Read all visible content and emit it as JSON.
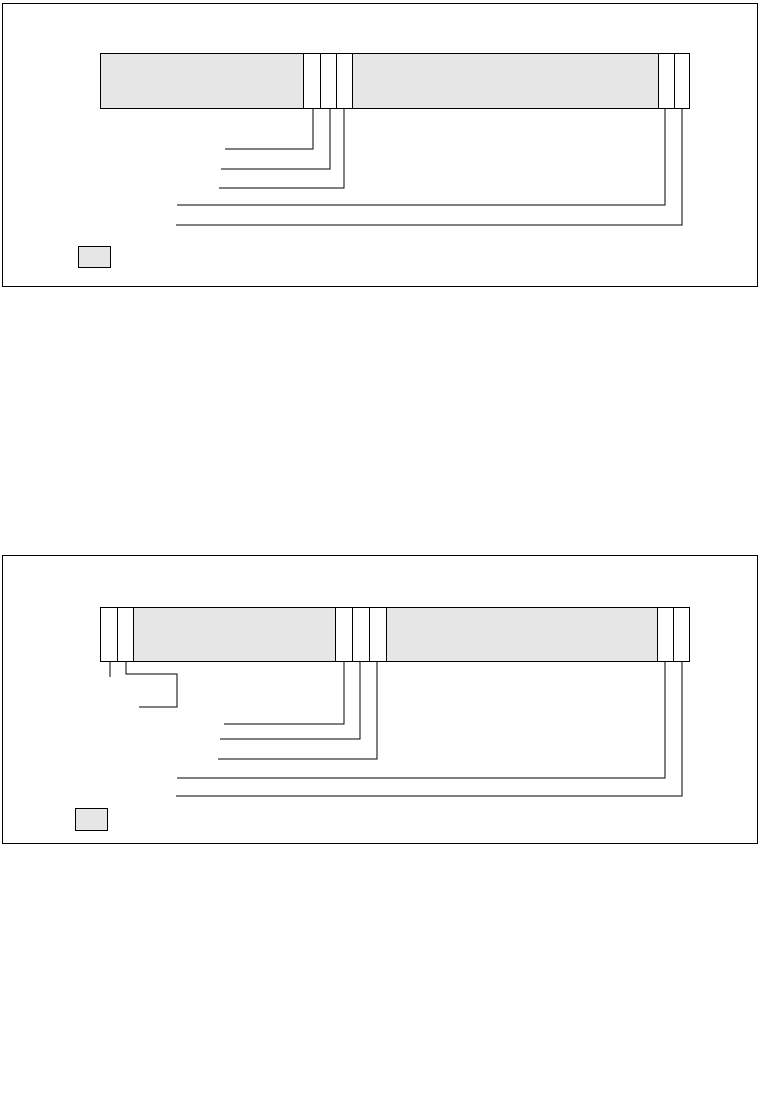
{
  "page": {
    "width": 760,
    "height": 1107,
    "background": "#ffffff"
  },
  "colors": {
    "line": "#000000",
    "field_fill": "#e6e6e6",
    "empty_fill": "#ffffff",
    "swatch_fill": "#e6e6e6"
  },
  "diagrams": [
    {
      "id": "field-structure-figure-1",
      "box": {
        "x": 2,
        "y": 3,
        "w": 756,
        "h": 284
      },
      "bar": {
        "x": 97,
        "y": 49,
        "w": 590,
        "h": 56
      },
      "cells": [
        {
          "w": 203,
          "fill": "field"
        },
        {
          "w": 17,
          "fill": "empty"
        },
        {
          "w": 16,
          "fill": "empty"
        },
        {
          "w": 16,
          "fill": "empty"
        },
        {
          "w": 307,
          "fill": "field"
        },
        {
          "w": 16,
          "fill": "empty"
        },
        {
          "w": 15,
          "fill": "empty"
        }
      ],
      "leaders": [
        [
          [
            310,
            105
          ],
          [
            310,
            145
          ],
          [
            222,
            145
          ]
        ],
        [
          [
            327,
            105
          ],
          [
            327,
            165
          ],
          [
            218,
            165
          ]
        ],
        [
          [
            341,
            105
          ],
          [
            341,
            184
          ],
          [
            216,
            184
          ]
        ],
        [
          [
            662,
            105
          ],
          [
            662,
            201
          ],
          [
            174,
            201
          ]
        ],
        [
          [
            679,
            105
          ],
          [
            679,
            221
          ],
          [
            173,
            221
          ]
        ]
      ],
      "swatch": {
        "x": 75,
        "y": 242,
        "w": 33,
        "h": 22
      }
    },
    {
      "id": "field-structure-figure-2",
      "box": {
        "x": 2,
        "y": 555,
        "w": 756,
        "h": 289
      },
      "bar": {
        "x": 97,
        "y": 51,
        "w": 590,
        "h": 55
      },
      "cells": [
        {
          "w": 16,
          "fill": "empty"
        },
        {
          "w": 16,
          "fill": "empty"
        },
        {
          "w": 203,
          "fill": "field"
        },
        {
          "w": 17,
          "fill": "empty"
        },
        {
          "w": 17,
          "fill": "empty"
        },
        {
          "w": 17,
          "fill": "empty"
        },
        {
          "w": 272,
          "fill": "field"
        },
        {
          "w": 16,
          "fill": "empty"
        },
        {
          "w": 16,
          "fill": "empty"
        }
      ],
      "leaders": [
        [
          [
            107,
            106
          ],
          [
            107,
            121
          ]
        ],
        [
          [
            123,
            106
          ],
          [
            123,
            118
          ],
          [
            174,
            118
          ],
          [
            174,
            151
          ],
          [
            136,
            151
          ]
        ],
        [
          [
            341,
            106
          ],
          [
            341,
            168
          ],
          [
            221,
            168
          ]
        ],
        [
          [
            357,
            106
          ],
          [
            357,
            183
          ],
          [
            217,
            183
          ]
        ],
        [
          [
            374,
            106
          ],
          [
            374,
            203
          ],
          [
            215,
            203
          ]
        ],
        [
          [
            662,
            106
          ],
          [
            662,
            222
          ],
          [
            174,
            222
          ]
        ],
        [
          [
            679,
            106
          ],
          [
            679,
            240
          ],
          [
            173,
            240
          ]
        ]
      ],
      "swatch": {
        "x": 72,
        "y": 252,
        "w": 33,
        "h": 23
      }
    }
  ]
}
